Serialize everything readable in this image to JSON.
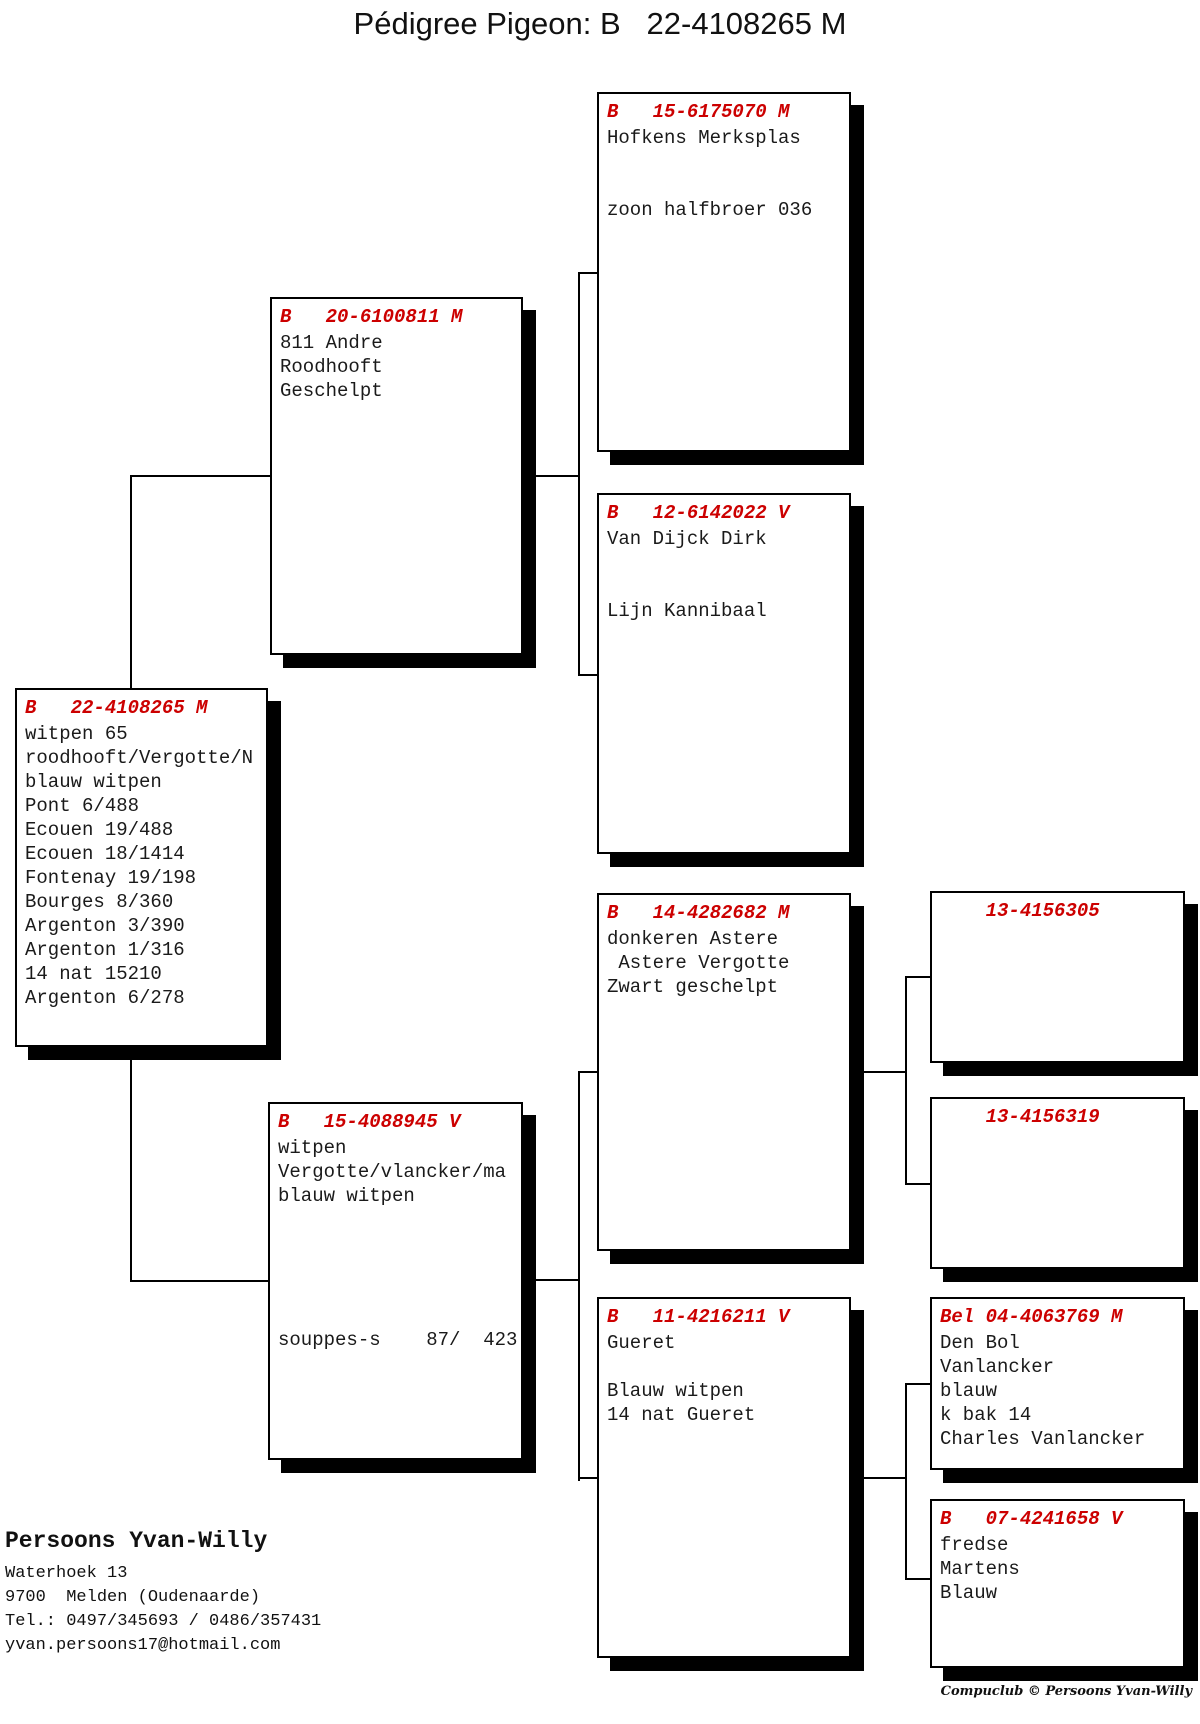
{
  "title": "Pédigree Pigeon: B   22-4108265 M",
  "colors": {
    "header_red": "#cc0000",
    "line_black": "#000000"
  },
  "boxes": {
    "sire_sire": {
      "header": "B   15-6175070 M",
      "body": "Hofkens Merksplas\n\n\nzoon halfbroer 036"
    },
    "sire": {
      "header": "B   20-6100811 M",
      "body": "811 Andre\nRoodhooft\nGeschelpt"
    },
    "sire_dam": {
      "header": "B   12-6142022 V",
      "body": "Van Dijck Dirk\n\n\nLijn Kannibaal"
    },
    "subject": {
      "header": "B   22-4108265 M",
      "body": "witpen 65\nroodhooft/Vergotte/N\nblauw witpen\nPont 6/488\nEcouen 19/488\nEcouen 18/1414\nFontenay 19/198\nBourges 8/360\nArgenton 3/390\nArgenton 1/316\n14 nat 15210\nArgenton 6/278"
    },
    "dam": {
      "header": "B   15-4088945 V",
      "body": "witpen\nVergotte/vlancker/ma\nblauw witpen\n\n\n\n\n\nsouppes-s    87/  423"
    },
    "dam_sire": {
      "header": "B   14-4282682 M",
      "body": "donkeren Astere\n Astere Vergotte\nZwart geschelpt"
    },
    "dam_dam": {
      "header": "B   11-4216211 V",
      "body": "Gueret\n\nBlauw witpen\n14 nat Gueret"
    },
    "dam_sire_sire": {
      "header": "    13-4156305",
      "body": ""
    },
    "dam_sire_dam": {
      "header": "    13-4156319",
      "body": ""
    },
    "dam_dam_sire": {
      "header": "Bel 04-4063769 M",
      "body": "Den Bol\nVanlancker\nblauw\nk bak 14\nCharles Vanlancker"
    },
    "dam_dam_dam": {
      "header": "B   07-4241658 V",
      "body": "fredse\nMartens\nBlauw"
    }
  },
  "owner": {
    "name": "Persoons Yvan-Willy",
    "address_line1": "Waterhoek 13",
    "address_line2": "9700  Melden (Oudenaarde)",
    "phone": "Tel.: 0497/345693 / 0486/357431",
    "email": "yvan.persoons17@hotmail.com"
  },
  "footer": "Compuclub © Persoons Yvan-Willy"
}
